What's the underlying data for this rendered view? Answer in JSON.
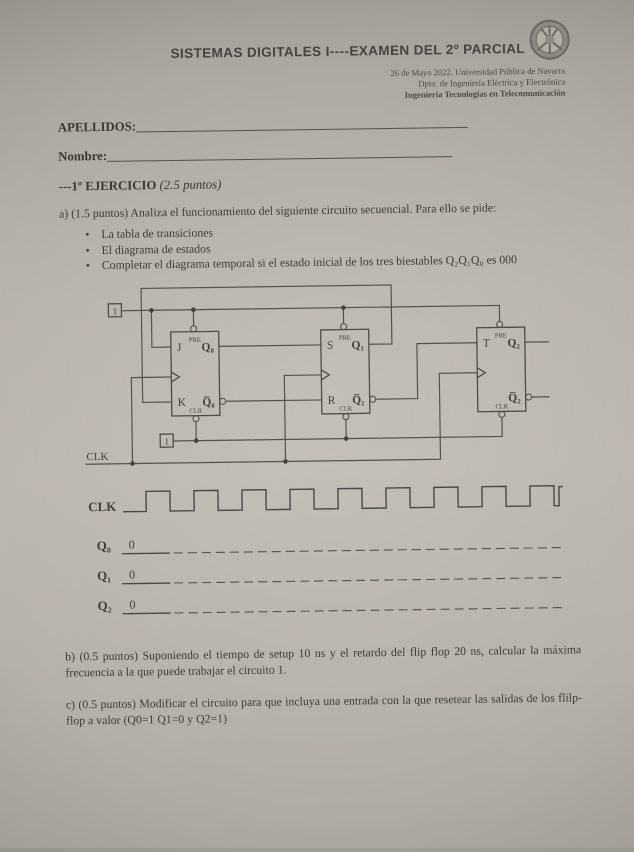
{
  "header": {
    "title": "SISTEMAS DIGITALES I----EXAMEN DEL 2º PARCIAL",
    "meta_line1": "26 de Mayo 2022. Universidad Pública de Navarra",
    "meta_line2": "Dpto. de Ingeniería Eléctrica y Electrónica",
    "meta_line3": "Ingeniería Tecnologías en Telecomunicación",
    "logo_name": "university-crest"
  },
  "fields": {
    "apellidos_label": "APELLIDOS:",
    "nombre_label": "Nombre:"
  },
  "exercise": {
    "heading": "---1º EJERCICIO",
    "heading_points": "(2.5 puntos)",
    "part_a": "a) (1.5 puntos) Analiza el funcionamiento del siguiente circuito secuencial. Para ello se pide:",
    "bullet_glyph": "•",
    "bullets": [
      "La tabla de transiciones",
      "El diagrama de estados",
      "Completar el diagrama temporal si el estado inicial de los tres biestables Q₂Q₁Q₀ es 000"
    ],
    "part_b": "b) (0.5 puntos) Suponiendo el tiempo de setup 10 ns y el retardo del flip flop 20 ns, calcular la máxima frecuencia a la que puede trabajar el circuito 1.",
    "part_c": "c) (0.5 puntos) Modificar el circuito para que incluya una entrada con la que resetear las salidas de los flilp-flop a valor (Q0=1 Q1=0 y Q2=1)"
  },
  "circuit": {
    "const_one_top": "1",
    "const_one_bottom": "1",
    "clk_label": "CLK",
    "ff1": {
      "pre": "PRE",
      "clr": "CLR",
      "in_top": "J",
      "in_bottom": "K",
      "out_top": "Q₀",
      "out_bottom": "Q̅₀"
    },
    "ff2": {
      "pre": "PRE",
      "clr": "CLR",
      "in_top": "S",
      "in_bottom": "R",
      "out_top": "Q₁",
      "out_bottom": "Q̅₁"
    },
    "ff3": {
      "pre": "PRE",
      "clr": "CLR",
      "in_top": "T",
      "out_top": "Q₂",
      "out_bottom": "Q̅₂"
    }
  },
  "timing": {
    "clk_label": "CLK",
    "rows": [
      {
        "label": "Q₀",
        "initial": "0"
      },
      {
        "label": "Q₁",
        "initial": "0"
      },
      {
        "label": "Q₂",
        "initial": "0"
      }
    ]
  }
}
